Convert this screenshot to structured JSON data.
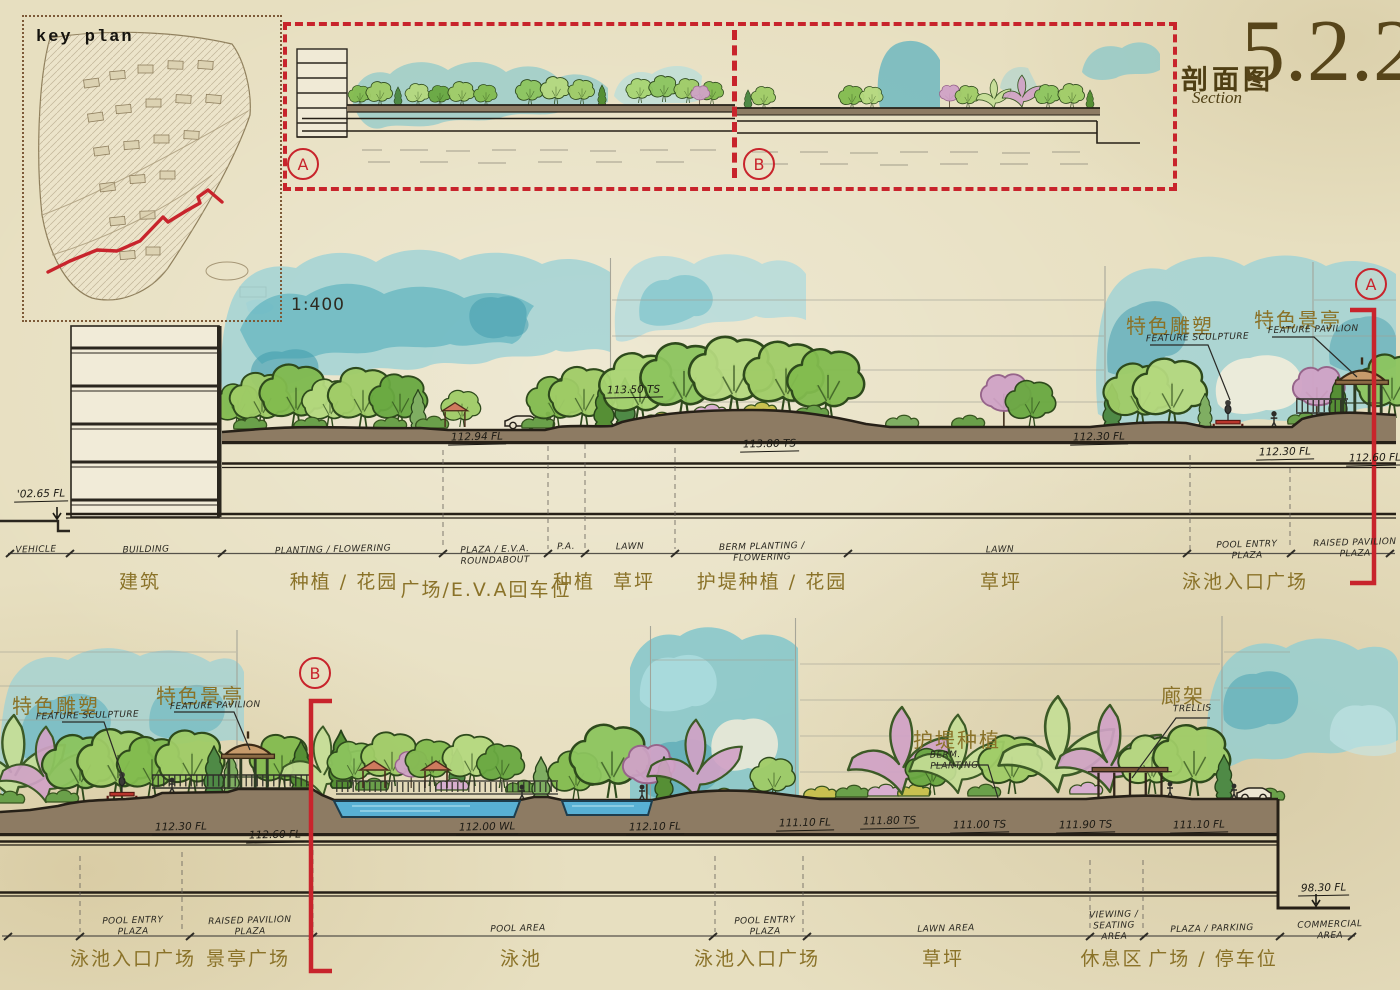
{
  "title": {
    "zh": "剖面图",
    "en": "Section",
    "number": "5.2.2"
  },
  "key_plan": {
    "label": "key plan"
  },
  "scale_label": "1:400",
  "markers": {
    "a": "A",
    "b": "B"
  },
  "section_a": {
    "left_elevation": "'02.65 FL",
    "tree_note": "113.50 TS",
    "elevations": [
      "112.94 FL",
      "113.80 TS",
      "112.30 FL",
      "112.30 FL",
      "112.60 FL"
    ],
    "annotations": [
      {
        "zh": "特色雕塑",
        "en": "FEATURE SCULPTURE"
      },
      {
        "zh": "特色景亭",
        "en": "FEATURE PAVILION"
      }
    ],
    "zones": [
      {
        "en": "VEHICLE",
        "zh": ""
      },
      {
        "en": "BUILDING",
        "zh": "建筑"
      },
      {
        "en": "PLANTING / FLOWERING",
        "zh": "种植 / 花园"
      },
      {
        "en": "PLAZA / E.V.A. ROUNDABOUT",
        "zh": "广场/E.V.A回车位"
      },
      {
        "en": "P.A.",
        "zh": "种植"
      },
      {
        "en": "LAWN",
        "zh": "草坪"
      },
      {
        "en": "BERM PLANTING / FLOWERING",
        "zh": "护堤种植 / 花园"
      },
      {
        "en": "LAWN",
        "zh": "草坪"
      },
      {
        "en": "POOL ENTRY PLAZA",
        "zh": "泳池入口广场"
      },
      {
        "en": "RAISED PAVILION PLAZA",
        "zh": ""
      }
    ]
  },
  "section_b": {
    "elevations": [
      "112.30 FL",
      "112.60 FL",
      "112.00 WL",
      "112.10 FL",
      "111.10 FL",
      "111.80 TS",
      "111.00 TS",
      "111.90 TS",
      "111.10 FL",
      "98.30 FL"
    ],
    "annotations": [
      {
        "zh": "特色雕塑",
        "en": "FEATURE SCULPTURE"
      },
      {
        "zh": "特色景亭",
        "en": "FEATURE PAVILION"
      },
      {
        "zh": "护堤种植",
        "en": "BERM. PLANTING"
      },
      {
        "zh": "廊架",
        "en": "TRELLIS"
      }
    ],
    "zones": [
      {
        "en": "POOL ENTRY PLAZA",
        "zh": "泳池入口广场"
      },
      {
        "en": "RAISED PAVILION PLAZA",
        "zh": "景亭广场"
      },
      {
        "en": "POOL AREA",
        "zh": "泳池"
      },
      {
        "en": "POOL ENTRY PLAZA",
        "zh": "泳池入口广场"
      },
      {
        "en": "LAWN AREA",
        "zh": "草坪"
      },
      {
        "en": "VIEWING / SEATING AREA",
        "zh": "休息区"
      },
      {
        "en": "PLAZA / PARKING",
        "zh": "广场 / 停车位"
      },
      {
        "en": "COMMERCIAL AREA",
        "zh": ""
      }
    ]
  }
}
